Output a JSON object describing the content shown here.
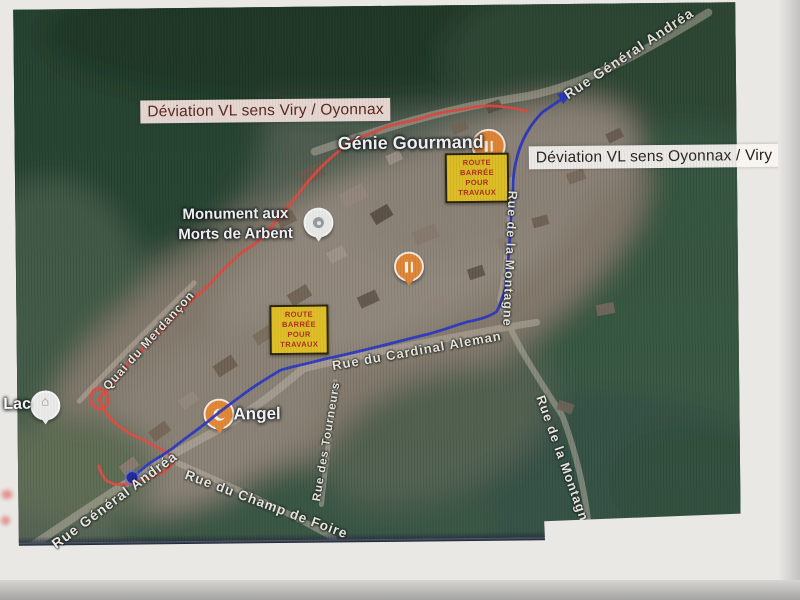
{
  "deviation_labels": [
    {
      "text": "Déviation VL sens Viry / Oyonnax"
    },
    {
      "text": "Déviation VL sens Oyonnax / Viry"
    }
  ],
  "road_closed_signs": [
    {
      "lines": [
        "ROUTE",
        "BARRÉE",
        "POUR",
        "TRAVAUX"
      ]
    },
    {
      "lines": [
        "ROUTE",
        "BARRÉE",
        "POUR",
        "TRAVAUX"
      ]
    }
  ],
  "pois": {
    "genie_gourmand": "Génie Gourmand",
    "monument_line1": "Monument aux",
    "monument_line2": "Morts de Arbent",
    "angel": "Angel",
    "lac": "Lac"
  },
  "streets": {
    "andrea_top": "Rue Général Andréa",
    "montagne_upper": "Rue de la Montagne",
    "cardinal_aleman": "Rue du Cardinal Aleman",
    "merdancon": "Quai du Merdançon",
    "tourneurs": "Rue des Tourneurs",
    "montagne_lower": "Rue de la Montagne",
    "andrea_bottom": "Rue Général Andréa",
    "champ_de_foire": "Rue du Champ de Foire"
  },
  "colors": {
    "route_red": "#e5483b",
    "route_blue": "#2733c4",
    "sign_bg": "#e7c41d",
    "sign_text": "#b3261c",
    "label_viry_bg": "#f2e1d9",
    "label_viry_text": "#5e2317",
    "label_oyonnax_bg": "#f8f5f0",
    "label_oyonnax_text": "#26211c",
    "poi_pin_orange": "#e8872f"
  }
}
